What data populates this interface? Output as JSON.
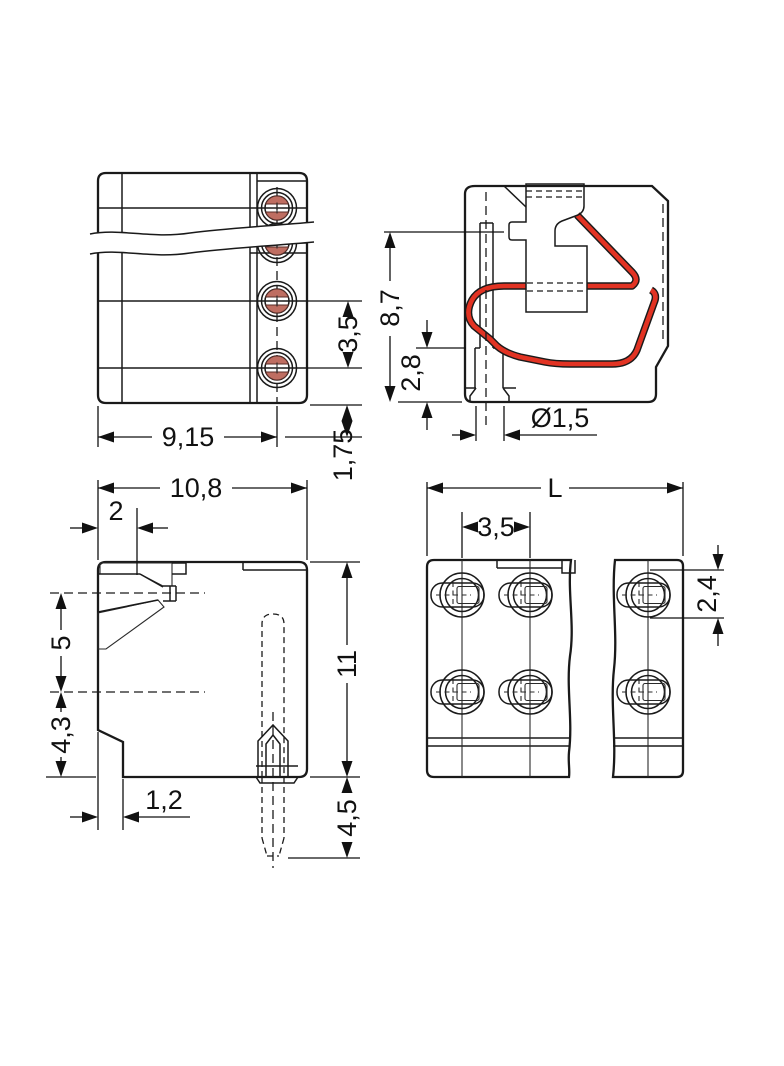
{
  "drawing": {
    "type": "technical-dimension-drawing",
    "units_style": "comma-decimal millimetres",
    "colors": {
      "body_gray": "#c7cbcd",
      "face_light": "#d6dadb",
      "inner_disc": "#ededee",
      "outline": "#1a1a1a",
      "pusher_orange": "#f08a1e",
      "spring_red": "#e23323",
      "port_red": "#e93123",
      "lens_red": "#bf6e62"
    },
    "views": {
      "top_side": {
        "dims": {
          "width": "9,15",
          "pitch": "3,5",
          "offset": "1,75"
        }
      },
      "section": {
        "dims": {
          "height": "8,7",
          "clamp": "2,8",
          "hole": "Ø1,5"
        }
      },
      "profile": {
        "dims": {
          "width": "10,8",
          "mouth": "2",
          "upper": "5",
          "lower": "4,3",
          "foot": "1,2",
          "height": "11",
          "pin": "4,5"
        }
      },
      "front": {
        "dims": {
          "length": "L",
          "pitch": "3,5",
          "port": "2,4"
        }
      }
    }
  }
}
